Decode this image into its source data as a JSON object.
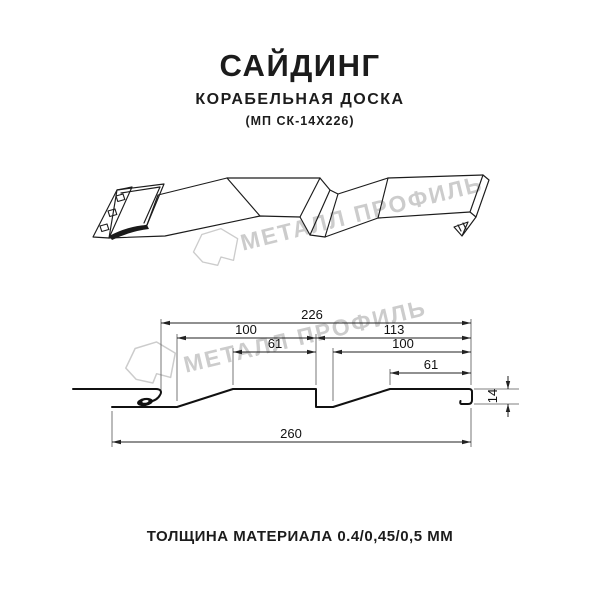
{
  "header": {
    "title": "САЙДИНГ",
    "subtitle": "КОРАБЕЛЬНАЯ ДОСКА",
    "model": "(МП СК-14Х226)"
  },
  "footer": {
    "text": "ТОЛЩИНА МАТЕРИАЛА 0.4/0,45/0,5 ММ"
  },
  "watermark": {
    "text": "МЕТАЛЛ ПРОФИЛЬ",
    "color": "#cccccc"
  },
  "drawing": {
    "type": "profile-cross-section",
    "product": "Сайдинг Корабельная доска МП СК-14Х226",
    "dimensions_mm": {
      "overall_cover_width": "226",
      "left_wave_width": "100",
      "right_wave_width": "113",
      "left_crest_width": "61",
      "right_slope_width": "100",
      "right_crest_width": "61",
      "full_sheet_width": "260",
      "profile_height": "14"
    }
  },
  "colors": {
    "ink": "#1c1c1c",
    "dim_line": "#222222",
    "watermark": "#cccccc",
    "background": "#ffffff"
  }
}
